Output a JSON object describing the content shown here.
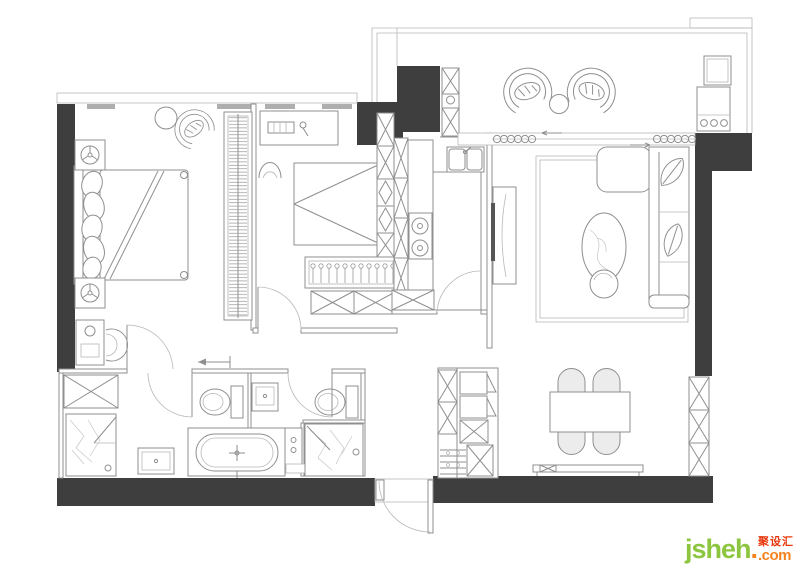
{
  "meta": {
    "type": "apartment-floor-plan",
    "description": "Top-view interior layout drawing of a two-bedroom apartment"
  },
  "colors": {
    "bg": "#ffffff",
    "wall": "#3e3e3e",
    "line": "#8f8f8f",
    "lite": "#b8b8b8",
    "bar": "#aeaeae",
    "logo_green": "#8cc63e",
    "logo_orange": "#f58220",
    "logo_red": "#e8380d"
  },
  "logo": {
    "main": "jsheh",
    "suffix": ".com",
    "cn": "聚设汇"
  },
  "rooms": [
    {
      "id": "master-bedroom",
      "name": "Master bedroom",
      "furniture": [
        "double bed with pillows",
        "headboard",
        "nightstand with lamp (top)",
        "nightstand with lamp (bottom)",
        "lounge chair",
        "round side table",
        "dressing table",
        "stool",
        "built-in wardrobe with hanging rail"
      ]
    },
    {
      "id": "bedroom-2",
      "name": "Second bedroom",
      "furniture": [
        "desk with laptop and lamp",
        "arched chair",
        "bed with folded duvet",
        "bedside storage cubes",
        "hanging closet",
        "low wardrobe cabinet"
      ]
    },
    {
      "id": "kitchen",
      "name": "Kitchen",
      "furniture": [
        "tall cabinet column",
        "counter with 2-burner cooktop",
        "island counter",
        "double sink"
      ]
    },
    {
      "id": "living-room",
      "name": "Living room",
      "furniture": [
        "TV panel",
        "wall TV",
        "area rug",
        "L-shaped sofa with leaf cushions",
        "oval marble coffee table",
        "round ottoman",
        "sliding balcony door"
      ]
    },
    {
      "id": "balcony",
      "name": "Balcony",
      "furniture": [
        "hanging egg chair (left)",
        "hanging egg chair (right)",
        "round tea table",
        "washing machine",
        "storage unit"
      ]
    },
    {
      "id": "dining-room",
      "name": "Dining area",
      "furniture": [
        "dining table",
        "4 chairs",
        "bench",
        "sideboard / shoe cabinet",
        "storage column"
      ]
    },
    {
      "id": "bathroom-master",
      "name": "Master bathroom",
      "furniture": [
        "storage cabinet",
        "walk-in shower",
        "vanity sink",
        "toilet",
        "freestanding bathtub"
      ]
    },
    {
      "id": "bathroom-guest",
      "name": "Guest bathroom",
      "furniture": [
        "vanity sink",
        "toilet",
        "walk-in shower",
        "towel mat"
      ]
    },
    {
      "id": "entry",
      "name": "Entry",
      "furniture": [
        "entrance door",
        "threshold",
        "shoe cabinet"
      ]
    }
  ]
}
